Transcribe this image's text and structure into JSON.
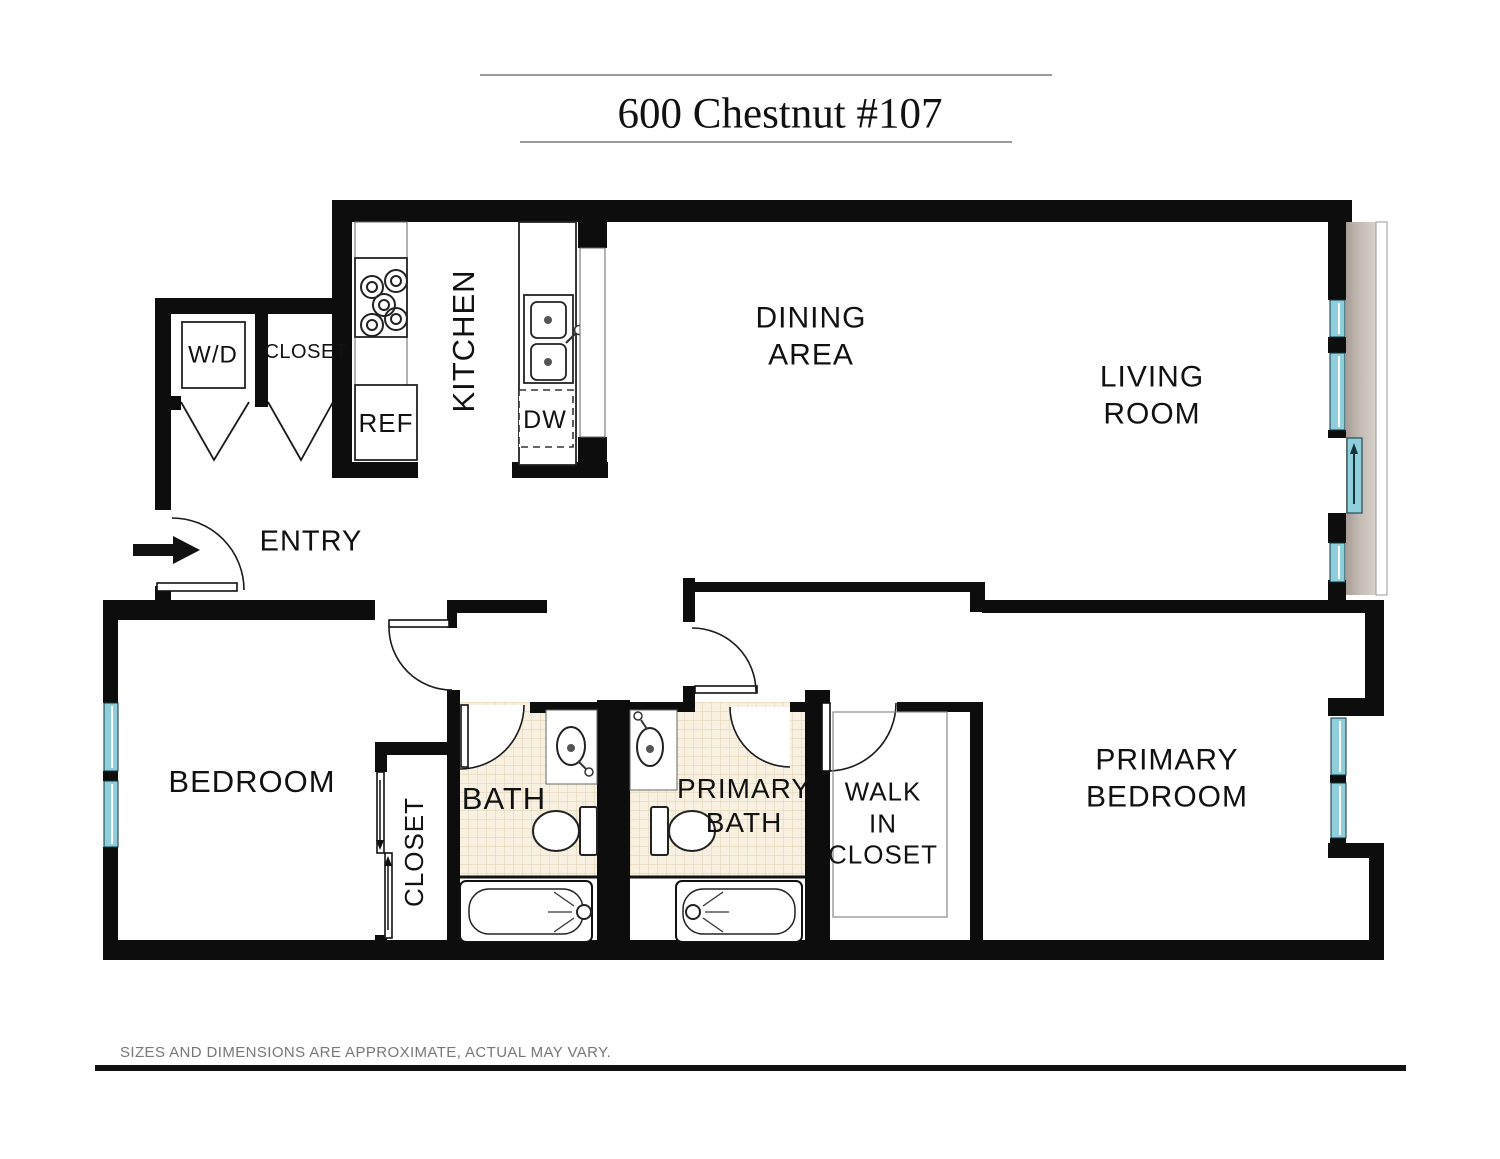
{
  "title": "600 Chestnut #107",
  "disclaimer": "SIZES AND DIMENSIONS ARE APPROXIMATE, ACTUAL MAY VARY.",
  "rooms": {
    "kitchen": "KITCHEN",
    "dining": {
      "line1": "DINING",
      "line2": "AREA"
    },
    "living": {
      "line1": "LIVING",
      "line2": "ROOM"
    },
    "entry": "ENTRY",
    "bedroom": "BEDROOM",
    "bedroom_closet": "CLOSET",
    "bath": "BATH",
    "primary_bath": {
      "line1": "PRIMARY",
      "line2": "BATH"
    },
    "walk_in_closet": {
      "line1": "WALK",
      "line2": "IN",
      "line3": "CLOSET"
    },
    "primary_bedroom": {
      "line1": "PRIMARY",
      "line2": "BEDROOM"
    }
  },
  "fixtures": {
    "washer_dryer": "W/D",
    "hall_closet": "CLOSET",
    "refrigerator": "REF",
    "dishwasher": "DW"
  },
  "colors": {
    "wall": "#0d0d0d",
    "window": "#8fcfdc",
    "balcony": "#b5aba3",
    "tile": "#f8f1e1",
    "tile_line": "#e7d9bd"
  }
}
